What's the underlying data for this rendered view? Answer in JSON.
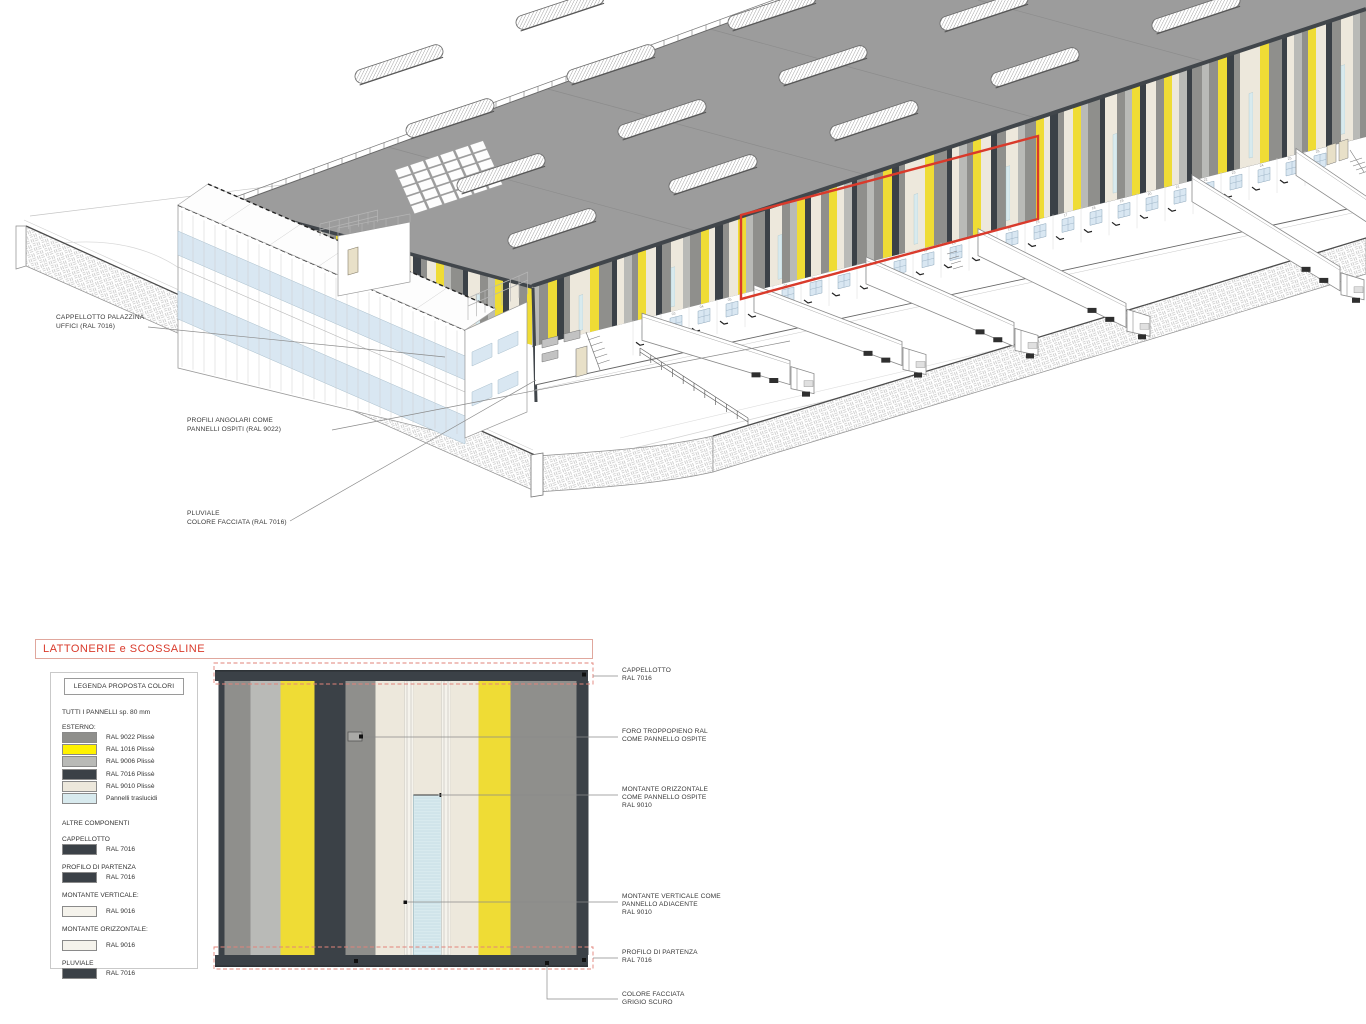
{
  "drawing": {
    "title_block": "LATTONERIE e SCOSSALINE"
  },
  "palette": {
    "ral9022": "#8F8F8C",
    "ral1016_facade": "#EFDC35",
    "ral1016_swatch": "#FFF200",
    "ral9006": "#B9BAB7",
    "ral7016": "#3B4147",
    "ral9010": "#EDE8DC",
    "ral9016": "#F5F3EC",
    "translucent": "#D8EAEE",
    "roof_grey": "#9C9C9C",
    "fascia_dark": "#41464B",
    "red_accent": "#D93A2B",
    "red_dashed": "#E2837A",
    "window_blue": "#D9E7F2",
    "leader_grey": "#8a8a8a"
  },
  "iso": {
    "labels": [
      {
        "id": "cappellotto-palazzina",
        "lines": [
          "CAPPELLOTTO PALAZZINA",
          "UFFICI (RAL 7016)"
        ],
        "x": 56,
        "y": 314
      },
      {
        "id": "profili-angolari",
        "lines": [
          "PROFILI ANGOLARI COME",
          "PANNELLI OSPITI (RAL 9022)"
        ],
        "x": 187,
        "y": 417
      },
      {
        "id": "pluviale",
        "lines": [
          "PLUVIALE",
          "COLORE FACCIATA (RAL 7016)"
        ],
        "x": 187,
        "y": 510
      }
    ],
    "dock_numbers": [
      "02",
      "03",
      "04",
      "05",
      "06",
      "07",
      "08",
      "09",
      "10",
      "11",
      "12",
      "13",
      "14",
      "15",
      "16",
      "17",
      "18",
      "19",
      "20",
      "21",
      "22",
      "23",
      "24",
      "25",
      "26"
    ]
  },
  "legend": {
    "title": "LEGENDA PROPOSTA COLORI",
    "subtitle": "TUTTI I PANNELLI sp. 80 mm",
    "esterno_heading": "ESTERNO:",
    "esterno_rows": [
      {
        "swatch": "ral9022",
        "label": "RAL 9022 Plissè"
      },
      {
        "swatch": "ral1016_swatch",
        "label": "RAL 1016 Plissè"
      },
      {
        "swatch": "ral9006",
        "label": "RAL 9006 Plissè"
      },
      {
        "swatch": "ral7016",
        "label": "RAL 7016 Plissè"
      },
      {
        "swatch": "ral9010",
        "label": "RAL 9010 Plissè"
      },
      {
        "swatch": "translucent",
        "label": "Pannelli traslucidi"
      }
    ],
    "altre_heading": "ALTRE COMPONENTI",
    "components": [
      {
        "heading": "CAPPELLOTTO",
        "swatch": "ral7016",
        "label": "RAL 7016",
        "gap": false
      },
      {
        "heading": "PROFILO DI PARTENZA",
        "swatch": "ral7016",
        "label": "RAL 7016",
        "gap": false
      },
      {
        "heading": "MONTANTE VERTICALE:",
        "swatch": "ral9016",
        "label": "RAL 9016",
        "gap": true
      },
      {
        "heading": "MONTANTE ORIZZONTALE:",
        "swatch": "ral9016",
        "label": "RAL 9016",
        "gap": true
      },
      {
        "heading": "PLUVIALE",
        "swatch": "ral7016",
        "label": "RAL 7016",
        "gap": false
      }
    ]
  },
  "detail": {
    "stripes": [
      {
        "c": "d",
        "w": 6
      },
      {
        "c": "m",
        "w": 26
      },
      {
        "c": "l",
        "w": 30
      },
      {
        "c": "y",
        "w": 34
      },
      {
        "c": "d",
        "w": 31
      },
      {
        "c": "m",
        "w": 30
      },
      {
        "c": "c",
        "w": 29
      },
      {
        "c": "v",
        "w": 9
      },
      {
        "c": "tc",
        "w": 28
      },
      {
        "c": "v",
        "w": 9
      },
      {
        "c": "c",
        "w": 28
      },
      {
        "c": "y",
        "w": 32
      },
      {
        "c": "m",
        "w": 66
      },
      {
        "c": "d",
        "w": 12
      }
    ],
    "annotations": [
      {
        "id": "cappellotto",
        "lines": [
          "CAPPELLOTTO",
          "RAL 7016"
        ],
        "top": 667
      },
      {
        "id": "foro-troppopieno",
        "lines": [
          "FORO TROPPOPIENO RAL",
          "COME PANNELLO OSPITE"
        ],
        "top": 728
      },
      {
        "id": "montante-orizzontale",
        "lines": [
          "MONTANTE ORIZZONTALE",
          "COME PANNELLO OSPITE",
          "RAL 9010"
        ],
        "top": 786
      },
      {
        "id": "montante-verticale",
        "lines": [
          "MONTANTE VERTICALE COME",
          "PANNELLO ADIACENTE",
          "RAL 9010"
        ],
        "top": 893
      },
      {
        "id": "profilo-di-partenza",
        "lines": [
          "PROFILO DI PARTENZA",
          "RAL 7016"
        ],
        "top": 949
      },
      {
        "id": "colore-facciata",
        "lines": [
          "COLORE FACCIATA",
          "GRIGIO SCURO"
        ],
        "top": 991
      }
    ]
  },
  "facade_stripes": [
    {
      "c": "l",
      "w": 7
    },
    {
      "c": "m",
      "w": 9
    },
    {
      "c": "y",
      "w": 9
    },
    {
      "c": "d",
      "w": 7
    },
    {
      "c": "m",
      "w": 6
    },
    {
      "c": "c",
      "w": 9
    },
    {
      "c": "t",
      "w": 4
    },
    {
      "c": "c",
      "w": 7
    },
    {
      "c": "y",
      "w": 9
    },
    {
      "c": "m",
      "w": 13
    },
    {
      "c": "d",
      "w": 5
    },
    {
      "c": "c",
      "w": 7
    },
    {
      "c": "l",
      "w": 8
    },
    {
      "c": "m",
      "w": 6
    },
    {
      "c": "y",
      "w": 8
    },
    {
      "c": "c",
      "w": 10
    },
    {
      "c": "d",
      "w": 6
    },
    {
      "c": "m",
      "w": 9
    },
    {
      "c": "t",
      "w": 4
    },
    {
      "c": "c",
      "w": 8
    },
    {
      "c": "l",
      "w": 7
    },
    {
      "c": "m",
      "w": 11
    },
    {
      "c": "y",
      "w": 8
    },
    {
      "c": "c",
      "w": 6
    },
    {
      "c": "d",
      "w": 8
    },
    {
      "c": "m",
      "w": 6
    },
    {
      "c": "c",
      "w": 9
    },
    {
      "c": "y",
      "w": 8
    },
    {
      "c": "l",
      "w": 7
    },
    {
      "c": "m",
      "w": 12
    },
    {
      "c": "d",
      "w": 5
    },
    {
      "c": "c",
      "w": 8
    },
    {
      "c": "t",
      "w": 4
    },
    {
      "c": "m",
      "w": 8
    },
    {
      "c": "l",
      "w": 7
    },
    {
      "c": "y",
      "w": 8
    },
    {
      "c": "d",
      "w": 6
    },
    {
      "c": "c",
      "w": 10
    },
    {
      "c": "m",
      "w": 8
    },
    {
      "c": "y",
      "w": 8
    },
    {
      "c": "c",
      "w": 7
    },
    {
      "c": "l",
      "w": 8
    },
    {
      "c": "d",
      "w": 5
    },
    {
      "c": "m",
      "w": 10
    }
  ]
}
